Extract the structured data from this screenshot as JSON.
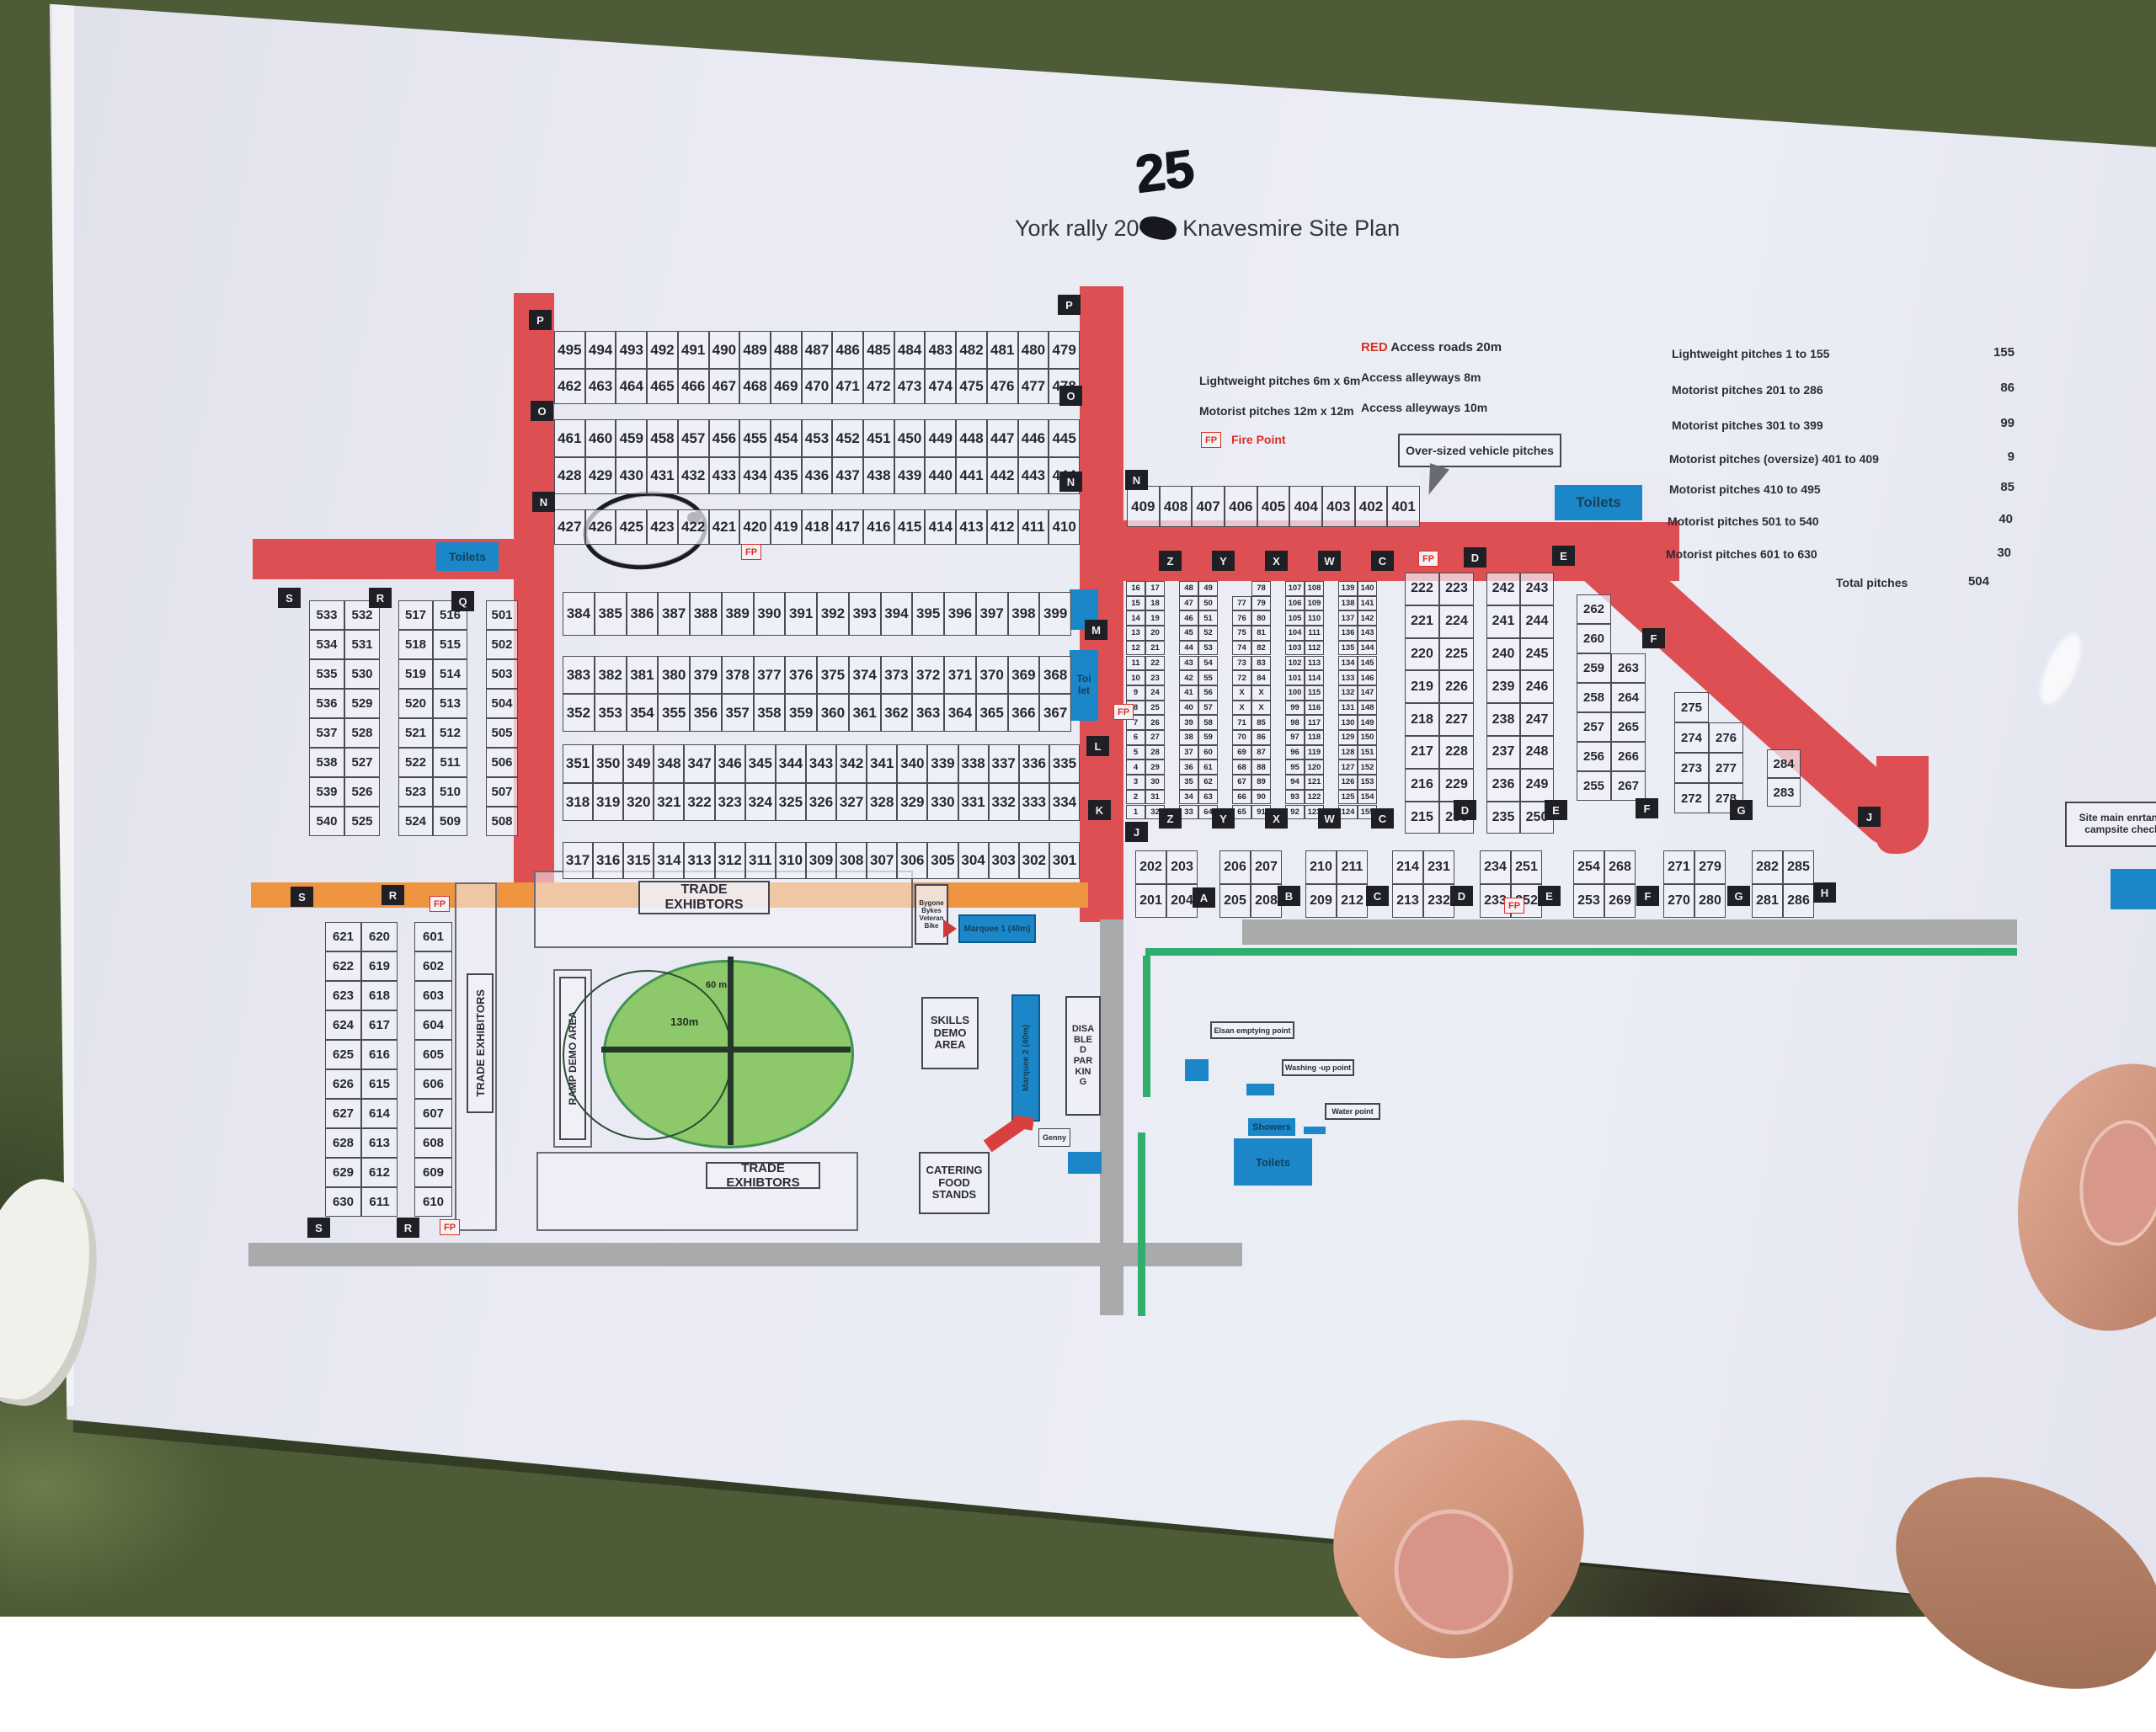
{
  "title": {
    "prefix": "York rally 20",
    "suffix": " Knavesmire Site Plan",
    "handwritten_year": "25"
  },
  "legend": {
    "red_word": "RED",
    "red_text": " Access roads 20m",
    "lightweight": "Lightweight pitches 6m x 6m",
    "alley8": "Access alleyways 8m",
    "motorist": "Motorist pitches 12m x 12m",
    "alley10": "Access alleyways 10m",
    "fp_abbr": "FP",
    "fire_point": "Fire Point",
    "oversized_callout": "Over-sized vehicle pitches"
  },
  "stats": {
    "rows": [
      {
        "label": "Lightweight pitches 1 to 155",
        "value": "155"
      },
      {
        "label": "Motorist pitches 201 to 286",
        "value": "86"
      },
      {
        "label": "Motorist pitches 301 to 399",
        "value": "99"
      },
      {
        "label": "Motorist pitches (oversize) 401 to 409",
        "value": "9"
      },
      {
        "label": "Motorist pitches 410 to 495",
        "value": "85"
      },
      {
        "label": "Motorist pitches 501 to 540",
        "value": "40"
      },
      {
        "label": "Motorist pitches 601 to 630",
        "value": "30"
      }
    ],
    "total_label": "Total pitches",
    "total_value": "504"
  },
  "pitches": {
    "row_495": [
      "495",
      "494",
      "493",
      "492",
      "491",
      "490",
      "489",
      "488",
      "487",
      "486",
      "485",
      "484",
      "483",
      "482",
      "481",
      "480",
      "479"
    ],
    "row_462": [
      "462",
      "463",
      "464",
      "465",
      "466",
      "467",
      "468",
      "469",
      "470",
      "471",
      "472",
      "473",
      "474",
      "475",
      "476",
      "477",
      "478"
    ],
    "row_461": [
      "461",
      "460",
      "459",
      "458",
      "457",
      "456",
      "455",
      "454",
      "453",
      "452",
      "451",
      "450",
      "449",
      "448",
      "447",
      "446",
      "445"
    ],
    "row_428": [
      "428",
      "429",
      "430",
      "431",
      "432",
      "433",
      "434",
      "435",
      "436",
      "437",
      "438",
      "439",
      "440",
      "441",
      "442",
      "443",
      "444"
    ],
    "row_427": [
      "427",
      "426",
      "425",
      "423",
      "422",
      "421",
      "420",
      "419",
      "418",
      "417",
      "416",
      "415",
      "414",
      "413",
      "412",
      "411",
      "410"
    ],
    "row_409": [
      "409",
      "408",
      "407",
      "406",
      "405",
      "404",
      "403",
      "402",
      "401"
    ],
    "row_384": [
      "384",
      "385",
      "386",
      "387",
      "388",
      "389",
      "390",
      "391",
      "392",
      "393",
      "394",
      "395",
      "396",
      "397",
      "398",
      "399"
    ],
    "row_383": [
      "383",
      "382",
      "381",
      "380",
      "379",
      "378",
      "377",
      "376",
      "375",
      "374",
      "373",
      "372",
      "371",
      "370",
      "369",
      "368"
    ],
    "row_352": [
      "352",
      "353",
      "354",
      "355",
      "356",
      "357",
      "358",
      "359",
      "360",
      "361",
      "362",
      "363",
      "364",
      "365",
      "366",
      "367"
    ],
    "row_351": [
      "351",
      "350",
      "349",
      "348",
      "347",
      "346",
      "345",
      "344",
      "343",
      "342",
      "341",
      "340",
      "339",
      "338",
      "337",
      "336",
      "335"
    ],
    "row_318": [
      "318",
      "319",
      "320",
      "321",
      "322",
      "323",
      "324",
      "325",
      "326",
      "327",
      "328",
      "329",
      "330",
      "331",
      "332",
      "333",
      "334"
    ],
    "row_317": [
      "317",
      "316",
      "315",
      "314",
      "313",
      "312",
      "311",
      "310",
      "309",
      "308",
      "307",
      "306",
      "305",
      "304",
      "303",
      "302",
      "301"
    ],
    "block_500_pair_a": [
      [
        "533",
        "532"
      ],
      [
        "534",
        "531"
      ],
      [
        "535",
        "530"
      ],
      [
        "536",
        "529"
      ],
      [
        "537",
        "528"
      ],
      [
        "538",
        "527"
      ],
      [
        "539",
        "526"
      ],
      [
        "540",
        "525"
      ]
    ],
    "block_500_pair_b": [
      [
        "517",
        "516"
      ],
      [
        "518",
        "515"
      ],
      [
        "519",
        "514"
      ],
      [
        "520",
        "513"
      ],
      [
        "521",
        "512"
      ],
      [
        "522",
        "511"
      ],
      [
        "523",
        "510"
      ],
      [
        "524",
        "509"
      ]
    ],
    "block_500_col_c": [
      "501",
      "502",
      "503",
      "504",
      "505",
      "506",
      "507",
      "508"
    ],
    "block_600_pair": [
      [
        "621",
        "620"
      ],
      [
        "622",
        "619"
      ],
      [
        "623",
        "618"
      ],
      [
        "624",
        "617"
      ],
      [
        "625",
        "616"
      ],
      [
        "626",
        "615"
      ],
      [
        "627",
        "614"
      ],
      [
        "628",
        "613"
      ],
      [
        "629",
        "612"
      ],
      [
        "630",
        "611"
      ]
    ],
    "block_600_col": [
      "601",
      "602",
      "603",
      "604",
      "605",
      "606",
      "607",
      "608",
      "609",
      "610"
    ],
    "lightweight_pair_1": [
      [
        "16",
        "17"
      ],
      [
        "15",
        "18"
      ],
      [
        "14",
        "19"
      ],
      [
        "13",
        "20"
      ],
      [
        "12",
        "21"
      ],
      [
        "11",
        "22"
      ],
      [
        "10",
        "23"
      ],
      [
        "9",
        "24"
      ],
      [
        "8",
        "25"
      ],
      [
        "7",
        "26"
      ],
      [
        "6",
        "27"
      ],
      [
        "5",
        "28"
      ],
      [
        "4",
        "29"
      ],
      [
        "3",
        "30"
      ],
      [
        "2",
        "31"
      ],
      [
        "1",
        "32"
      ]
    ],
    "lightweight_pair_2": [
      [
        "48",
        "49"
      ],
      [
        "47",
        "50"
      ],
      [
        "46",
        "51"
      ],
      [
        "45",
        "52"
      ],
      [
        "44",
        "53"
      ],
      [
        "43",
        "54"
      ],
      [
        "42",
        "55"
      ],
      [
        "41",
        "56"
      ],
      [
        "40",
        "57"
      ],
      [
        "39",
        "58"
      ],
      [
        "38",
        "59"
      ],
      [
        "37",
        "60"
      ],
      [
        "36",
        "61"
      ],
      [
        "35",
        "62"
      ],
      [
        "34",
        "63"
      ],
      [
        "33",
        "64"
      ]
    ],
    "lightweight_pair_3": [
      [
        "",
        "78"
      ],
      [
        "77",
        "79"
      ],
      [
        "76",
        "80"
      ],
      [
        "75",
        "81"
      ],
      [
        "74",
        "82"
      ],
      [
        "73",
        "83"
      ],
      [
        "72",
        "84"
      ],
      [
        "X",
        "X"
      ],
      [
        "X",
        "X"
      ],
      [
        "71",
        "85"
      ],
      [
        "70",
        "86"
      ],
      [
        "69",
        "87"
      ],
      [
        "68",
        "88"
      ],
      [
        "67",
        "89"
      ],
      [
        "66",
        "90"
      ],
      [
        "65",
        "91"
      ]
    ],
    "lightweight_pair_4": [
      [
        "107",
        "108"
      ],
      [
        "106",
        "109"
      ],
      [
        "105",
        "110"
      ],
      [
        "104",
        "111"
      ],
      [
        "103",
        "112"
      ],
      [
        "102",
        "113"
      ],
      [
        "101",
        "114"
      ],
      [
        "100",
        "115"
      ],
      [
        "99",
        "116"
      ],
      [
        "98",
        "117"
      ],
      [
        "97",
        "118"
      ],
      [
        "96",
        "119"
      ],
      [
        "95",
        "120"
      ],
      [
        "94",
        "121"
      ],
      [
        "93",
        "122"
      ],
      [
        "92",
        "123"
      ]
    ],
    "lightweight_pair_5": [
      [
        "139",
        "140"
      ],
      [
        "138",
        "141"
      ],
      [
        "137",
        "142"
      ],
      [
        "136",
        "143"
      ],
      [
        "135",
        "144"
      ],
      [
        "134",
        "145"
      ],
      [
        "133",
        "146"
      ],
      [
        "132",
        "147"
      ],
      [
        "131",
        "148"
      ],
      [
        "130",
        "149"
      ],
      [
        "129",
        "150"
      ],
      [
        "128",
        "151"
      ],
      [
        "127",
        "152"
      ],
      [
        "126",
        "153"
      ],
      [
        "125",
        "154"
      ],
      [
        "124",
        "155"
      ]
    ],
    "block_200_pair_d": [
      [
        "222",
        "223"
      ],
      [
        "221",
        "224"
      ],
      [
        "220",
        "225"
      ],
      [
        "219",
        "226"
      ],
      [
        "218",
        "227"
      ],
      [
        "217",
        "228"
      ],
      [
        "216",
        "229"
      ],
      [
        "215",
        "230"
      ]
    ],
    "block_200_pair_e": [
      [
        "242",
        "243"
      ],
      [
        "241",
        "244"
      ],
      [
        "240",
        "245"
      ],
      [
        "239",
        "246"
      ],
      [
        "238",
        "247"
      ],
      [
        "237",
        "248"
      ],
      [
        "236",
        "249"
      ],
      [
        "235",
        "250"
      ]
    ],
    "block_200_col_f": [
      [
        "262",
        ""
      ],
      [
        "260",
        ""
      ],
      [
        "259",
        "263"
      ],
      [
        "258",
        "264"
      ],
      [
        "257",
        "265"
      ],
      [
        "256",
        "266"
      ],
      [
        "255",
        "267"
      ]
    ],
    "block_200_col_g": [
      [
        "275",
        ""
      ],
      [
        "274",
        "276"
      ],
      [
        "273",
        "277"
      ],
      [
        "272",
        "278"
      ]
    ],
    "block_200_col_h": [
      "284",
      "283"
    ],
    "block_200_bottom": [
      [
        [
          "202",
          "203"
        ],
        [
          "201",
          "204"
        ]
      ],
      [
        [
          "206",
          "207"
        ],
        [
          "205",
          "208"
        ]
      ],
      [
        [
          "210",
          "211"
        ],
        [
          "209",
          "212"
        ]
      ],
      [
        [
          "214",
          "231"
        ],
        [
          "213",
          "232"
        ]
      ],
      [
        [
          "234",
          "251"
        ],
        [
          "233",
          "252"
        ]
      ],
      [
        [
          "254",
          "268"
        ],
        [
          "253",
          "269"
        ]
      ],
      [
        [
          "271",
          "279"
        ],
        [
          "270",
          "280"
        ]
      ],
      [
        [
          "282",
          "285"
        ],
        [
          "281",
          "286"
        ]
      ]
    ]
  },
  "markers": [
    "P",
    "P",
    "O",
    "O",
    "N",
    "N",
    "N",
    "S",
    "R",
    "Q",
    "M",
    "L",
    "K",
    "Z",
    "Y",
    "X",
    "W",
    "C",
    "Z",
    "Y",
    "X",
    "W",
    "C",
    "J",
    "D",
    "E",
    "D",
    "E",
    "F",
    "F",
    "G",
    "J",
    "A",
    "B",
    "C",
    "D",
    "E",
    "F",
    "G",
    "H",
    "S",
    "R",
    "S",
    "R"
  ],
  "fp_label": "FP",
  "areas": {
    "trade_exhibtors_top": "TRADE EXHIBTORS",
    "trade_exhibitors_left": "TRADE EXHIBITORS",
    "trade_exhibtors_bottom": "TRADE EXHIBTORS",
    "ramp_demo": "RAMP DEMO AREA",
    "skills_demo": "SKILLS\nDEMO\nAREA",
    "catering": "CATERING\nFOOD\nSTANDS",
    "disabled_parking": "DISA\nBLE\nD\nPAR\nKIN\nG",
    "genny": "Genny",
    "marquee1": "Marquee 1 (40m)",
    "marquee2": "Marquee 2 (40m)",
    "bygone": "Bygone\nBykes\nVeteran\nBike",
    "arena_width": "130m",
    "arena_radius": "60\nm"
  },
  "facilities": {
    "toilets_top_left": "Toilets",
    "toilets_right": "Toilets",
    "toilet_mid": "Toi\nlet",
    "elsan": "Elsan emptying point",
    "washing_up": "Washing -up point",
    "water_point": "Water point",
    "showers": "Showers",
    "toilets_main": "Toilets",
    "entrance": "Site main enrtance\ncampsite check-"
  },
  "colors": {
    "road_red": "#dd4f52",
    "road_orange": "#ef9440",
    "road_grey": "#a9aaac",
    "fence_green": "#2fae6e",
    "facility_blue": "#1b87c9",
    "arena_green": "#8dc96a",
    "fire_point_red": "#d93025",
    "marker_black": "#1f1f26",
    "paper": "#e9eaf3"
  }
}
